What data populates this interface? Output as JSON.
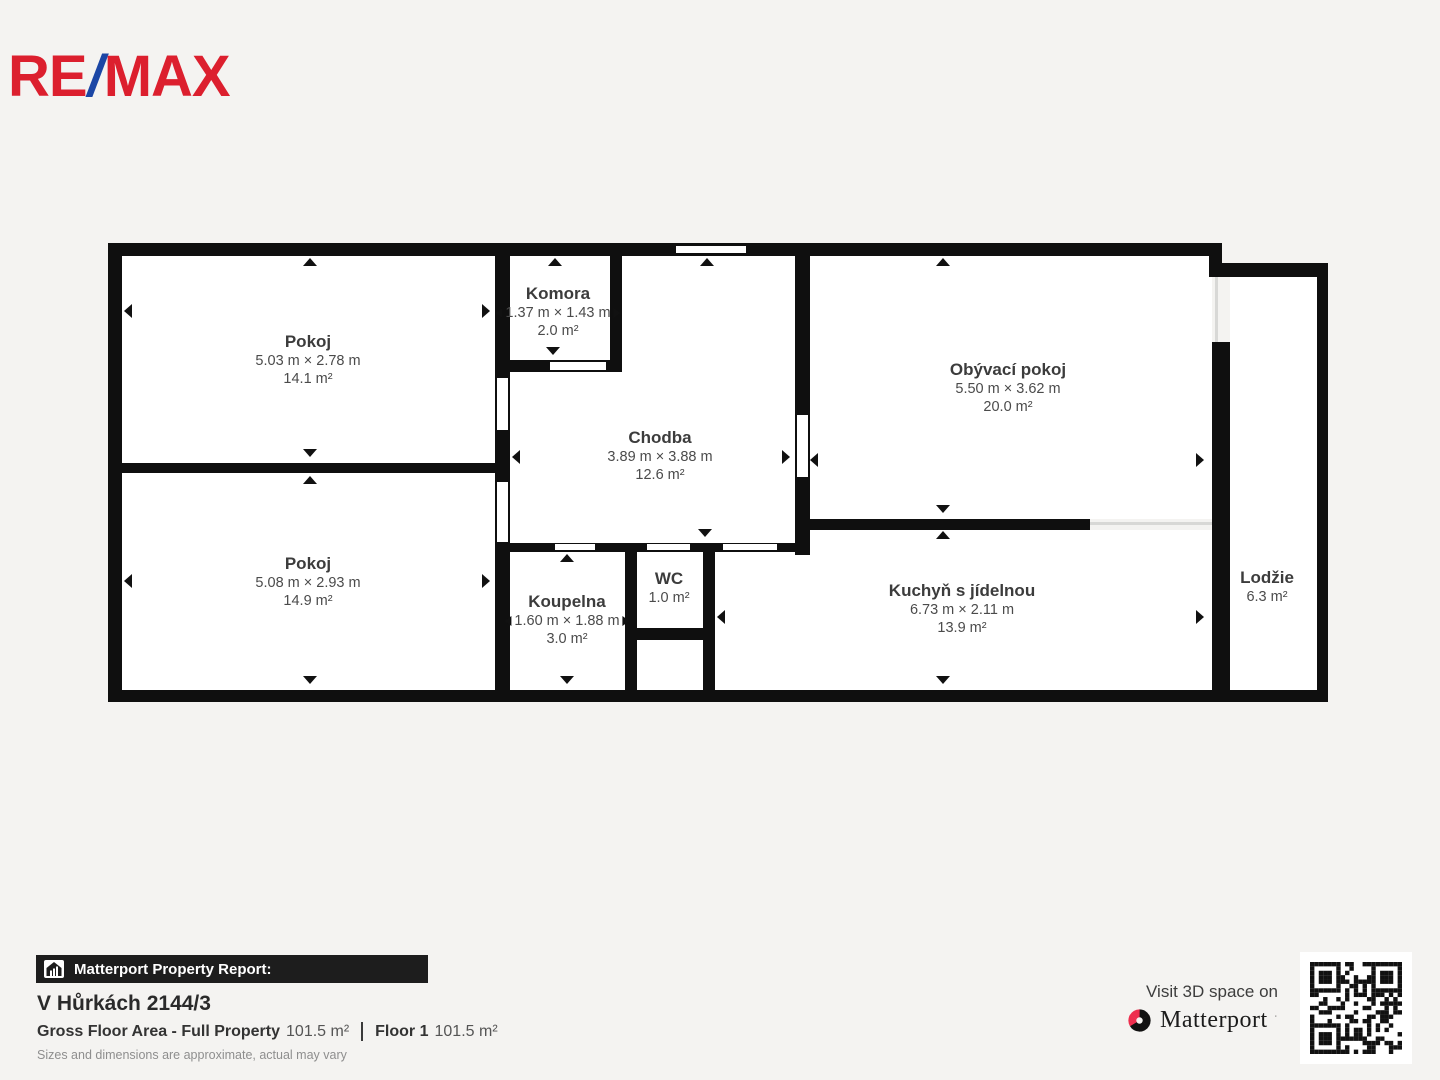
{
  "colors": {
    "background": "#f4f3f1",
    "wall": "#0f0f0f",
    "remax_red": "#dc1f2e",
    "remax_blue": "#1b46a5",
    "matterport_red": "#ee2e4e",
    "report_bar_bg": "#1d1d1d"
  },
  "brand": {
    "re": "RE",
    "slash": "/",
    "max": "MAX"
  },
  "floorplan": {
    "rooms": [
      {
        "id": "pokoj-1",
        "name": "Pokoj",
        "dims": "5.03 m × 2.78 m",
        "area": "14.1 m²"
      },
      {
        "id": "pokoj-2",
        "name": "Pokoj",
        "dims": "5.08 m × 2.93 m",
        "area": "14.9 m²"
      },
      {
        "id": "komora",
        "name": "Komora",
        "dims": "1.37 m × 1.43 m",
        "area": "2.0 m²"
      },
      {
        "id": "chodba",
        "name": "Chodba",
        "dims": "3.89 m × 3.88 m",
        "area": "12.6 m²"
      },
      {
        "id": "koupelna",
        "name": "Koupelna",
        "dims": "1.60 m × 1.88 m",
        "area": "3.0 m²"
      },
      {
        "id": "wc",
        "name": "WC",
        "area": "1.0 m²"
      },
      {
        "id": "kuchyn",
        "name": "Kuchyň s jídelnou",
        "dims": "6.73 m × 2.11 m",
        "area": "13.9 m²"
      },
      {
        "id": "obyvaci-pokoj",
        "name": "Obývací pokoj",
        "dims": "5.50 m × 3.62 m",
        "area": "20.0 m²"
      },
      {
        "id": "lodzie",
        "name": "Lodžie",
        "area": "6.3 m²"
      }
    ]
  },
  "footer": {
    "report_label": "Matterport Property Report:",
    "address": "V Hůrkách 2144/3",
    "gross_label": "Gross Floor Area - Full Property",
    "gross_value": "101.5 m²",
    "floor_label": "Floor 1",
    "floor_value": "101.5 m²",
    "disclaimer": "Sizes and dimensions are approximate, actual may vary",
    "visit_text": "Visit 3D space on",
    "matterport_wordmark": "Matterport"
  }
}
